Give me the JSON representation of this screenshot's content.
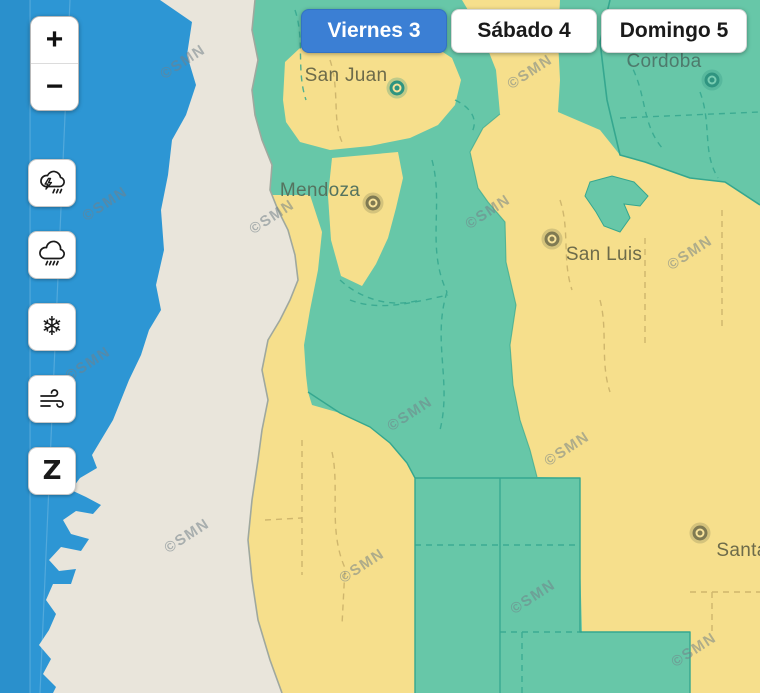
{
  "app": {
    "title": "SMN weather alert map"
  },
  "colors": {
    "ocean": "#2D96D4",
    "chile_land": "#E9E5DB",
    "alert_green": "#67C7A8",
    "alert_yellow": "#F6DF8C",
    "border_green": "#35A78F",
    "border_yellow": "#CBB26A",
    "chile_border": "#9FA89E",
    "tab_active_bg": "#3B7FD4",
    "marker_teal": "#2F9480",
    "marker_olive": "#7F7A52"
  },
  "map_controls": {
    "zoom_in": "+",
    "zoom_out": "−"
  },
  "day_tabs": [
    {
      "label": "Viernes 3",
      "active": true
    },
    {
      "label": "Sábado 4",
      "active": false
    },
    {
      "label": "Domingo 5",
      "active": false
    }
  ],
  "hazard_buttons": [
    {
      "id": "storms",
      "icon": "storm-cloud-lightning-icon"
    },
    {
      "id": "rain",
      "icon": "rain-cloud-icon"
    },
    {
      "id": "snow",
      "icon": "snowflake-icon",
      "glyph": "❄"
    },
    {
      "id": "wind",
      "icon": "wind-icon"
    },
    {
      "id": "zonda",
      "icon": "zonda-z-icon",
      "glyph": "Z"
    }
  ],
  "cities": [
    {
      "name": "San Juan",
      "color": "#6d6b4a",
      "tone": "teal",
      "marker": {
        "x": 397,
        "y": 88
      },
      "label": {
        "x": 346,
        "y": 76
      }
    },
    {
      "name": "Mendoza",
      "color": "#55735f",
      "tone": "olive",
      "marker": {
        "x": 373,
        "y": 203
      },
      "label": {
        "x": 320,
        "y": 191
      }
    },
    {
      "name": "Cordoba",
      "color": "#4e7a6c",
      "tone": "teal",
      "marker": {
        "x": 712,
        "y": 80
      },
      "label": {
        "x": 664,
        "y": 62
      }
    },
    {
      "name": "San Luis",
      "color": "#6d6b4a",
      "tone": "olive",
      "marker": {
        "x": 552,
        "y": 239
      },
      "label": {
        "x": 604,
        "y": 255
      }
    },
    {
      "name": "Santa",
      "color": "#6d6b4a",
      "tone": "olive",
      "marker": {
        "x": 700,
        "y": 533
      },
      "label": {
        "x": 742,
        "y": 551
      }
    }
  ],
  "watermark": {
    "text": "©SMN",
    "positions": [
      {
        "x": 183,
        "y": 62
      },
      {
        "x": 530,
        "y": 72
      },
      {
        "x": 105,
        "y": 204
      },
      {
        "x": 272,
        "y": 217
      },
      {
        "x": 488,
        "y": 212
      },
      {
        "x": 690,
        "y": 253
      },
      {
        "x": 88,
        "y": 364
      },
      {
        "x": 410,
        "y": 414
      },
      {
        "x": 567,
        "y": 449
      },
      {
        "x": 187,
        "y": 536
      },
      {
        "x": 362,
        "y": 566
      },
      {
        "x": 533,
        "y": 597
      },
      {
        "x": 694,
        "y": 650
      }
    ]
  }
}
